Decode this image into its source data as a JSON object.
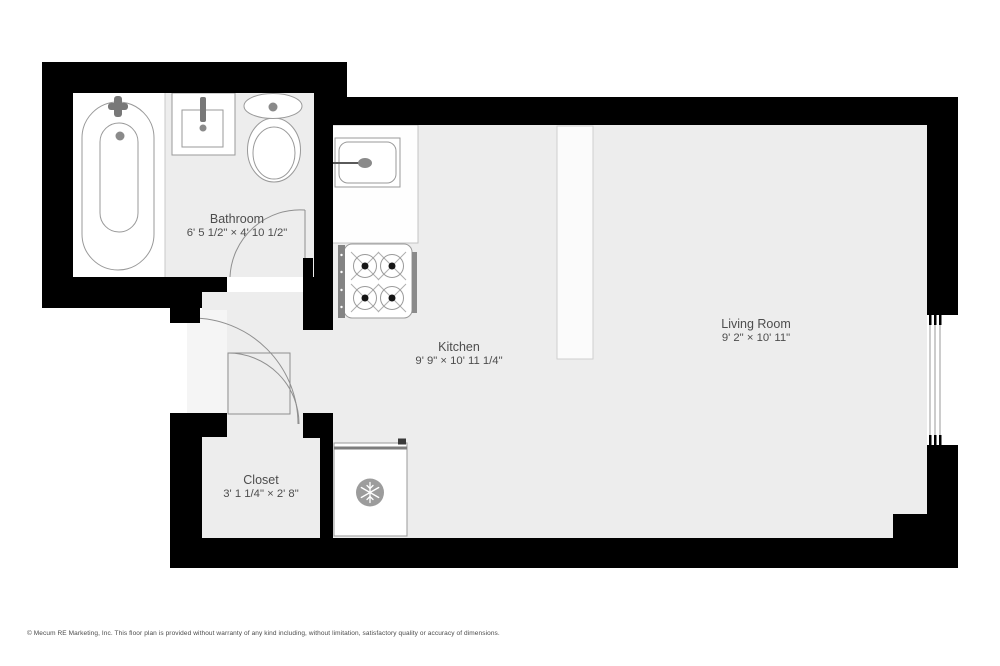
{
  "plan": {
    "title": "Studio apartment floor plan",
    "rooms": [
      {
        "id": "bathroom",
        "name": "Bathroom",
        "dimensions": "6' 5 1/2\" × 4' 10 1/2\""
      },
      {
        "id": "kitchen",
        "name": "Kitchen",
        "dimensions": "9' 9\" × 10' 11 1/4\""
      },
      {
        "id": "living-room",
        "name": "Living Room",
        "dimensions": "9' 2\" × 10' 11\""
      },
      {
        "id": "closet",
        "name": "Closet",
        "dimensions": "3' 1 1/4\" × 2' 8\""
      }
    ],
    "fixtures": [
      "bathtub",
      "bathroom-sink",
      "toilet",
      "kitchen-counter",
      "kitchen-sink",
      "stove",
      "refrigerator",
      "snowflake-icon",
      "room-divider",
      "window",
      "bathroom-door",
      "entry-door",
      "closet-door"
    ],
    "colors": {
      "wall": "#000000",
      "floor": "#ededed",
      "entry_nook_floor": "#f5f5f5",
      "fixture_fill": "#ffffff",
      "fixture_outline": "#9a9a9a",
      "door_arc": "#8f8f8f",
      "appliance_gray": "#848484",
      "label_text": "#4d4d4d",
      "page_background": "#ffffff"
    }
  },
  "footer": {
    "copyright": "© Mecum RE Marketing, Inc. This floor plan is provided without warranty of any kind including, without limitation, satisfactory quality or accuracy of dimensions."
  }
}
